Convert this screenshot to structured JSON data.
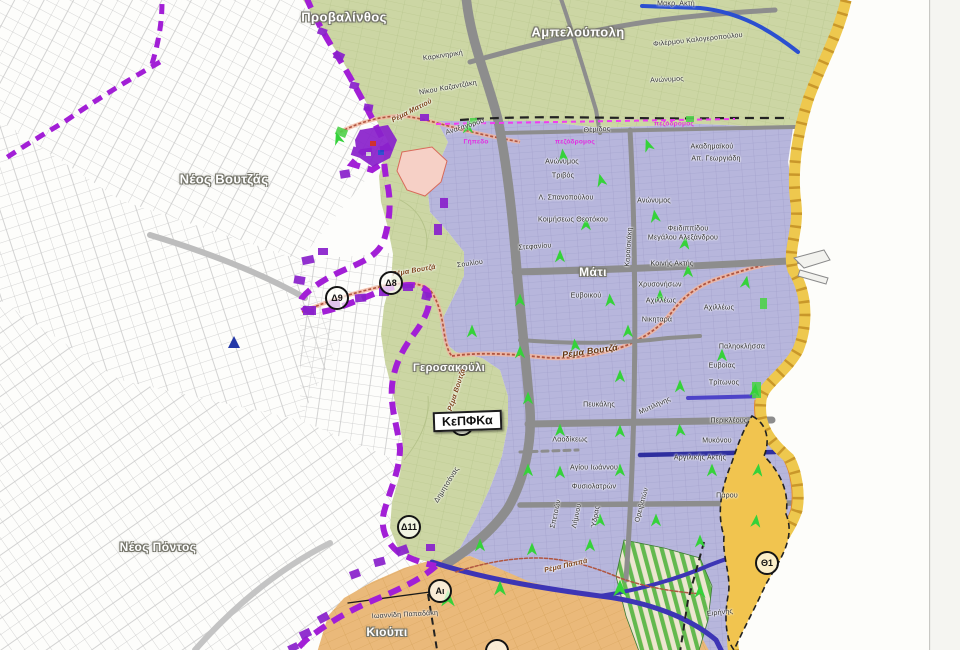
{
  "map": {
    "kepfka_box": {
      "label": "ΚεΠΦΚα"
    },
    "colors": {
      "parcel-line": "#c9c9c9",
      "green-zone": "#ccd6a4",
      "green-line": "#b4c289",
      "blue-zone": "#b7b6dc",
      "blue-line": "#9e9cc9",
      "orange-zone": "#eab97a",
      "orange-line": "#d3a055",
      "stripe-green": "#63b94e",
      "yellow-coast": "#eec84e",
      "yellow-tick": "#c9972a",
      "orange-coast": "#e08a30",
      "road-gray": "#8d8d8d",
      "road-blue": "#2b4fd0",
      "road-navy": "#3d35b5",
      "boundary-purple": "#a21fd6",
      "blob-purple": "#8a22cc",
      "magenta": "#f03df0",
      "arrow-green": "#35d23a",
      "stream-red": "#b05540",
      "theta-zone": "#f1c44f",
      "sea": "#fdfdfa"
    },
    "markers": [
      {
        "label": "Δ9",
        "x": 337,
        "y": 298
      },
      {
        "label": "Δ8",
        "x": 391,
        "y": 283
      },
      {
        "label": "Δ10",
        "x": 462,
        "y": 424
      },
      {
        "label": "Δ11",
        "x": 409,
        "y": 527
      },
      {
        "label": "Αι",
        "x": 440,
        "y": 591
      },
      {
        "label": "Θ1",
        "x": 767,
        "y": 563
      },
      {
        "label": "",
        "x": 497,
        "y": 651
      }
    ],
    "labels": [
      {
        "t": "Προβαλίνθος",
        "x": 344,
        "y": 17,
        "c": "area"
      },
      {
        "t": "Αμπελούπολη",
        "x": 578,
        "y": 32,
        "c": "area"
      },
      {
        "t": "Νέος Βουτζάς",
        "x": 224,
        "y": 179,
        "c": "area"
      },
      {
        "t": "Νέος Πόντος",
        "x": 158,
        "y": 547,
        "c": "area",
        "s": 12
      },
      {
        "t": "Μάτι",
        "x": 593,
        "y": 272,
        "c": "area",
        "s": 12
      },
      {
        "t": "Γεροσακούλι",
        "x": 449,
        "y": 368,
        "c": "area",
        "s": 11
      },
      {
        "t": "Κιούπι",
        "x": 387,
        "y": 632,
        "c": "area",
        "s": 12
      },
      {
        "t": "Καρκινηρική",
        "x": 443,
        "y": 56,
        "r": -8
      },
      {
        "t": "Νίκου Καζαντζάκη",
        "x": 448,
        "y": 88,
        "r": -10
      },
      {
        "t": "Αναξαγόρου",
        "x": 465,
        "y": 127,
        "r": -18
      },
      {
        "t": "Μακρ. Ακτή",
        "x": 676,
        "y": 4
      },
      {
        "t": "Φιλέρμου Καλογεροπούλου",
        "x": 698,
        "y": 40,
        "r": -6
      },
      {
        "t": "Ανώνυμος",
        "x": 667,
        "y": 80,
        "r": -3
      },
      {
        "t": "Θέμιδος",
        "x": 597,
        "y": 130,
        "r": -4
      },
      {
        "t": "Ανώνυμος",
        "x": 562,
        "y": 162
      },
      {
        "t": "Τριβός",
        "x": 563,
        "y": 176
      },
      {
        "t": "Λ. Σπανοπούλου",
        "x": 566,
        "y": 198
      },
      {
        "t": "Κοιμήσεως Θεοτόκου",
        "x": 573,
        "y": 220
      },
      {
        "t": "Στεφανίου",
        "x": 535,
        "y": 247,
        "r": -4
      },
      {
        "t": "Σουλίου",
        "x": 470,
        "y": 264,
        "r": -8
      },
      {
        "t": "Ακαδημαϊκού",
        "x": 712,
        "y": 147
      },
      {
        "t": "Απ. Γεωργιάδη",
        "x": 716,
        "y": 159
      },
      {
        "t": "Ανώνυμος",
        "x": 654,
        "y": 201
      },
      {
        "t": "Φειδιππίδου",
        "x": 688,
        "y": 229
      },
      {
        "t": "Μεγάλου Αλεξάνδρου",
        "x": 683,
        "y": 238
      },
      {
        "t": "Κοινής Ακτής",
        "x": 672,
        "y": 264
      },
      {
        "t": "Χρυσονήσων",
        "x": 660,
        "y": 285
      },
      {
        "t": "Αχιλλέως",
        "x": 661,
        "y": 301
      },
      {
        "t": "Αχιλλέως",
        "x": 719,
        "y": 308
      },
      {
        "t": "Νικηταρά",
        "x": 657,
        "y": 320
      },
      {
        "t": "Ευβοικού",
        "x": 586,
        "y": 296
      },
      {
        "t": "Καραϊσκάκη",
        "x": 629,
        "y": 247,
        "r": -86
      },
      {
        "t": "Παληοκλήσσα",
        "x": 742,
        "y": 347
      },
      {
        "t": "Ευβοίας",
        "x": 722,
        "y": 366
      },
      {
        "t": "Τρίτωνος",
        "x": 724,
        "y": 383
      },
      {
        "t": "Μυτιλήνης",
        "x": 655,
        "y": 406,
        "r": -24
      },
      {
        "t": "Περικλέους",
        "x": 729,
        "y": 421
      },
      {
        "t": "Μυκόνου",
        "x": 717,
        "y": 441
      },
      {
        "t": "Αργιλικής Ακτής",
        "x": 700,
        "y": 458
      },
      {
        "t": "Πάρου",
        "x": 727,
        "y": 496
      },
      {
        "t": "Πευκάλης",
        "x": 599,
        "y": 405
      },
      {
        "t": "Λαοδίκεως",
        "x": 570,
        "y": 440
      },
      {
        "t": "Αγίου Ιωάννου",
        "x": 594,
        "y": 468
      },
      {
        "t": "Φυσιολατρών",
        "x": 594,
        "y": 487
      },
      {
        "t": "Σπετσών",
        "x": 556,
        "y": 514,
        "r": -78
      },
      {
        "t": "Λήμνου",
        "x": 577,
        "y": 516,
        "r": -78
      },
      {
        "t": "Ύδρας",
        "x": 596,
        "y": 517,
        "r": -80
      },
      {
        "t": "Ορειβατών",
        "x": 642,
        "y": 505,
        "r": -75
      },
      {
        "t": "Δημητσάνας",
        "x": 447,
        "y": 485,
        "r": -58
      },
      {
        "t": "Ιωαννίδη Παπαδάκη",
        "x": 405,
        "y": 615,
        "r": -3
      },
      {
        "t": "Ειρήνης",
        "x": 720,
        "y": 613,
        "r": -6
      },
      {
        "t": "Ρέμα Ματιού",
        "x": 412,
        "y": 111,
        "r": -27,
        "c": "stream"
      },
      {
        "t": "Ρέμα Βουτζά",
        "x": 414,
        "y": 271,
        "r": -10,
        "c": "stream"
      },
      {
        "t": "Ρέμα Βουτζά",
        "x": 590,
        "y": 351,
        "r": -8,
        "c": "stream-big"
      },
      {
        "t": "Ρέμα Βουτζά",
        "x": 457,
        "y": 390,
        "r": -72,
        "c": "stream"
      },
      {
        "t": "Ρέμα Παππά",
        "x": 566,
        "y": 566,
        "r": -13,
        "c": "stream"
      },
      {
        "t": "Γήπεδο",
        "x": 476,
        "y": 142,
        "c": "mag"
      },
      {
        "t": "πεζόδρομος",
        "x": 575,
        "y": 142,
        "c": "mag"
      },
      {
        "t": "πεζόδρομος",
        "x": 674,
        "y": 124,
        "c": "mag"
      }
    ],
    "arrows": [
      [
        338,
        138,
        -18
      ],
      [
        468,
        127,
        0
      ],
      [
        563,
        155,
        -6
      ],
      [
        601,
        180,
        -14
      ],
      [
        648,
        145,
        -20
      ],
      [
        586,
        224,
        0
      ],
      [
        655,
        216,
        -8
      ],
      [
        685,
        243,
        6
      ],
      [
        560,
        256,
        0
      ],
      [
        610,
        300,
        -4
      ],
      [
        520,
        300,
        0
      ],
      [
        660,
        296,
        0
      ],
      [
        688,
        271,
        0
      ],
      [
        746,
        282,
        10
      ],
      [
        628,
        331,
        0
      ],
      [
        575,
        345,
        -6
      ],
      [
        520,
        352,
        0
      ],
      [
        472,
        331,
        0
      ],
      [
        620,
        376,
        0
      ],
      [
        680,
        386,
        0
      ],
      [
        755,
        390,
        6
      ],
      [
        528,
        398,
        0
      ],
      [
        560,
        430,
        0
      ],
      [
        620,
        431,
        0
      ],
      [
        680,
        430,
        -6
      ],
      [
        712,
        470,
        0
      ],
      [
        758,
        470,
        6
      ],
      [
        528,
        470,
        0
      ],
      [
        560,
        472,
        0
      ],
      [
        620,
        470,
        0
      ],
      [
        600,
        520,
        0
      ],
      [
        656,
        520,
        0
      ],
      [
        700,
        541,
        0
      ],
      [
        480,
        545,
        0
      ],
      [
        532,
        549,
        0
      ],
      [
        590,
        545,
        0
      ],
      [
        448,
        598,
        0,
        17
      ],
      [
        500,
        588,
        0,
        15
      ],
      [
        620,
        588,
        0,
        17
      ],
      [
        700,
        591,
        0,
        14
      ],
      [
        722,
        355,
        0
      ],
      [
        756,
        521,
        6
      ]
    ]
  }
}
